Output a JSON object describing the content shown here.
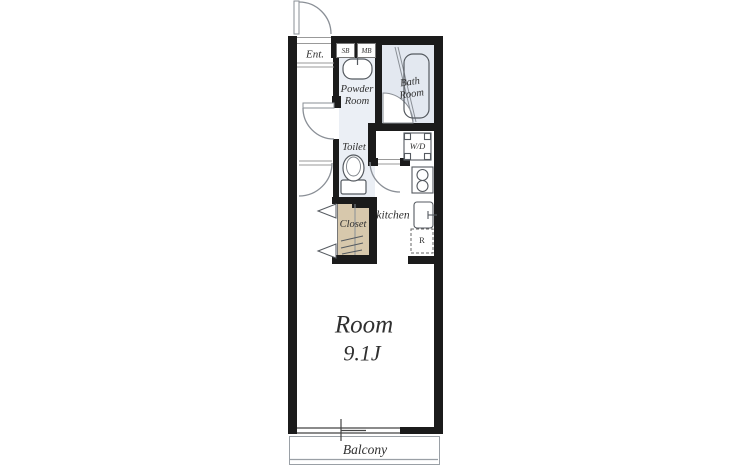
{
  "floor_plan": {
    "entrance": {
      "label": "Ent.",
      "shoe_box_label": "SB",
      "meter_box_label": "MB"
    },
    "powder_room": {
      "label_lines": [
        "Powder",
        "Room"
      ]
    },
    "bath_room": {
      "label_lines": [
        "Bath",
        "Room"
      ]
    },
    "toilet": {
      "label": "Toilet"
    },
    "washer_dryer": {
      "label": "W/D"
    },
    "kitchen": {
      "label": "kitchen",
      "refrigerator_label": "R"
    },
    "closet": {
      "label": "Closet"
    },
    "main_room": {
      "label": "Room",
      "size": "9.1J"
    },
    "balcony": {
      "label": "Balcony"
    }
  },
  "colors": {
    "wall": "#1b1b1b",
    "bath_floor": "#e3e8f0",
    "powder_floor": "#ebeff5",
    "closet_floor": "#d7c8ac",
    "fixture_line": "#555a60",
    "door_line": "#8a8f96",
    "balcony_line": "#9aa0a6",
    "text": "#2f2f2f"
  }
}
